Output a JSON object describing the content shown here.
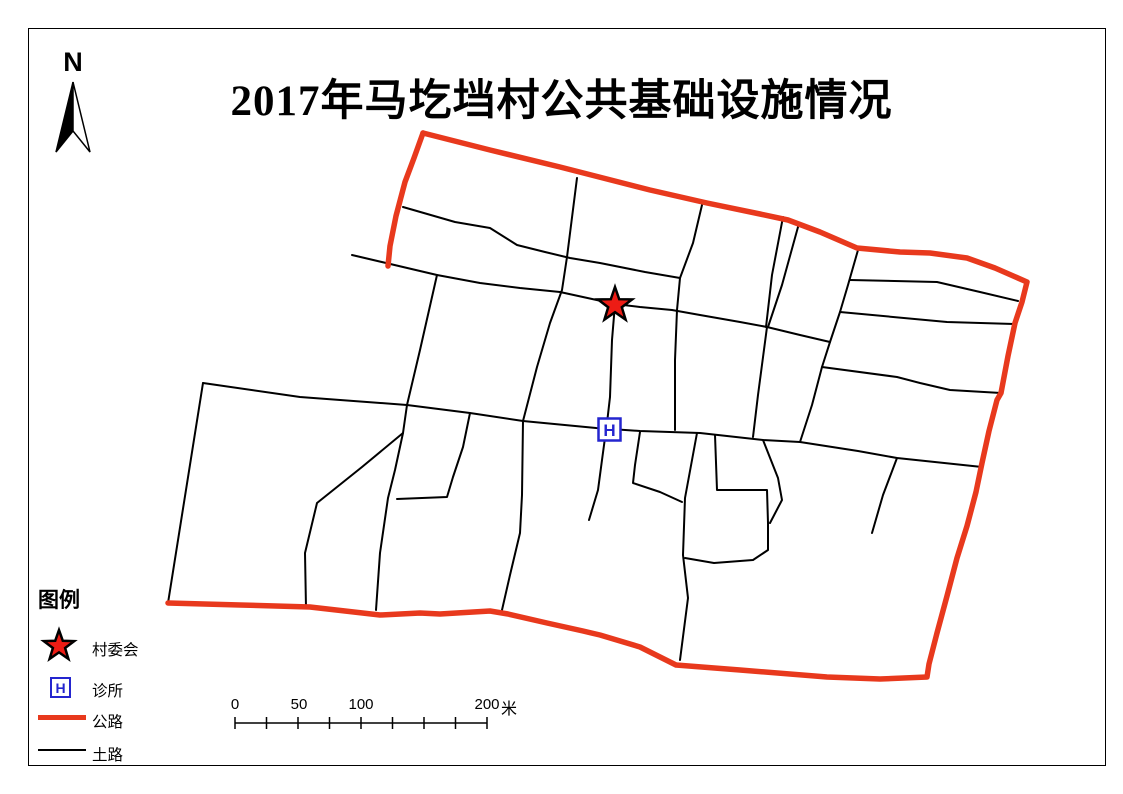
{
  "title": "2017年马圪垱村公共基础设施情况",
  "north": {
    "label": "N"
  },
  "legend": {
    "title": "图例",
    "items": [
      {
        "label": "村委会",
        "symbol": "red-star"
      },
      {
        "label": "诊所",
        "symbol": "blue-h-box",
        "letter": "H"
      },
      {
        "label": "公路",
        "symbol": "thick-red-line"
      },
      {
        "label": "土路",
        "symbol": "thin-black-line"
      }
    ]
  },
  "scale_bar": {
    "labels": [
      "0",
      "50",
      "100",
      "200"
    ],
    "unit": "米"
  },
  "colors": {
    "highway": "#E8391D",
    "committee_star": "#ED1C15",
    "clinic_blue": "#2425CF",
    "dirt_road": "#000000"
  }
}
